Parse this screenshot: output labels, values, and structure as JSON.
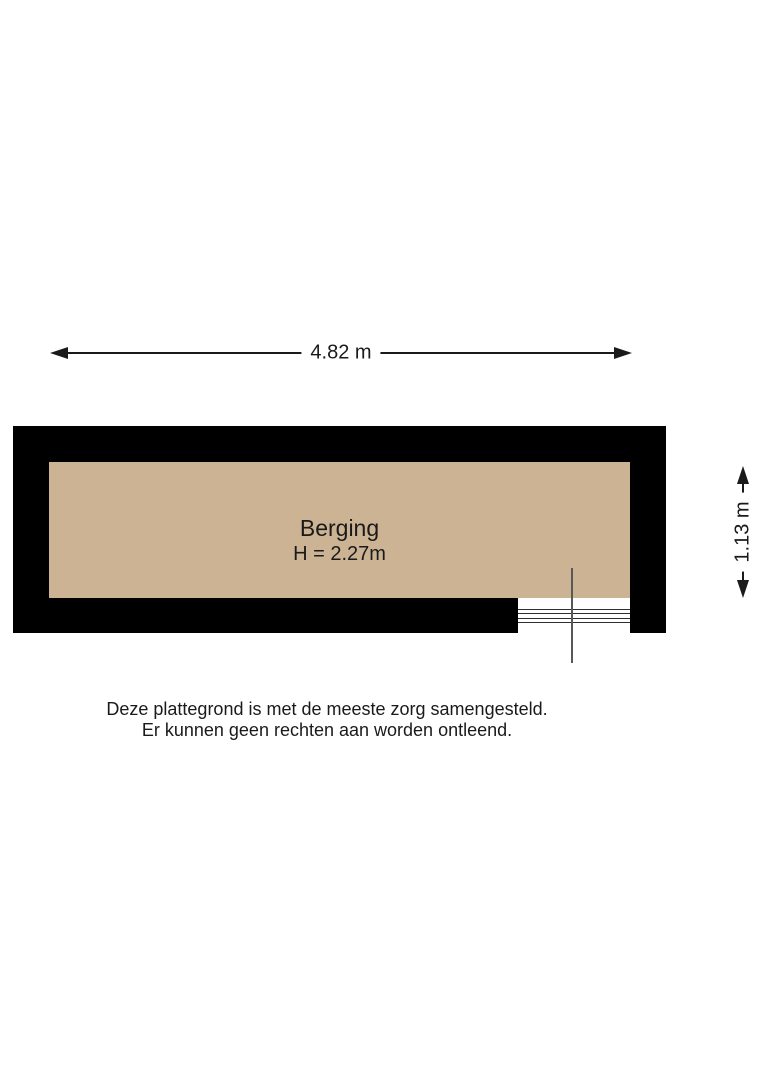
{
  "floorplan": {
    "room": {
      "label": "Berging",
      "ceiling_height_label": "H = 2.27m",
      "floor_color": "#ccb394",
      "wall_color": "#000000"
    },
    "dimensions": {
      "width": {
        "label": "4.82 m"
      },
      "depth": {
        "label": "1.13 m"
      }
    },
    "disclaimer": {
      "line1": "Deze plattegrond is met de meeste zorg samengesteld.",
      "line2": "Er kunnen geen rechten aan worden ontleend."
    }
  }
}
